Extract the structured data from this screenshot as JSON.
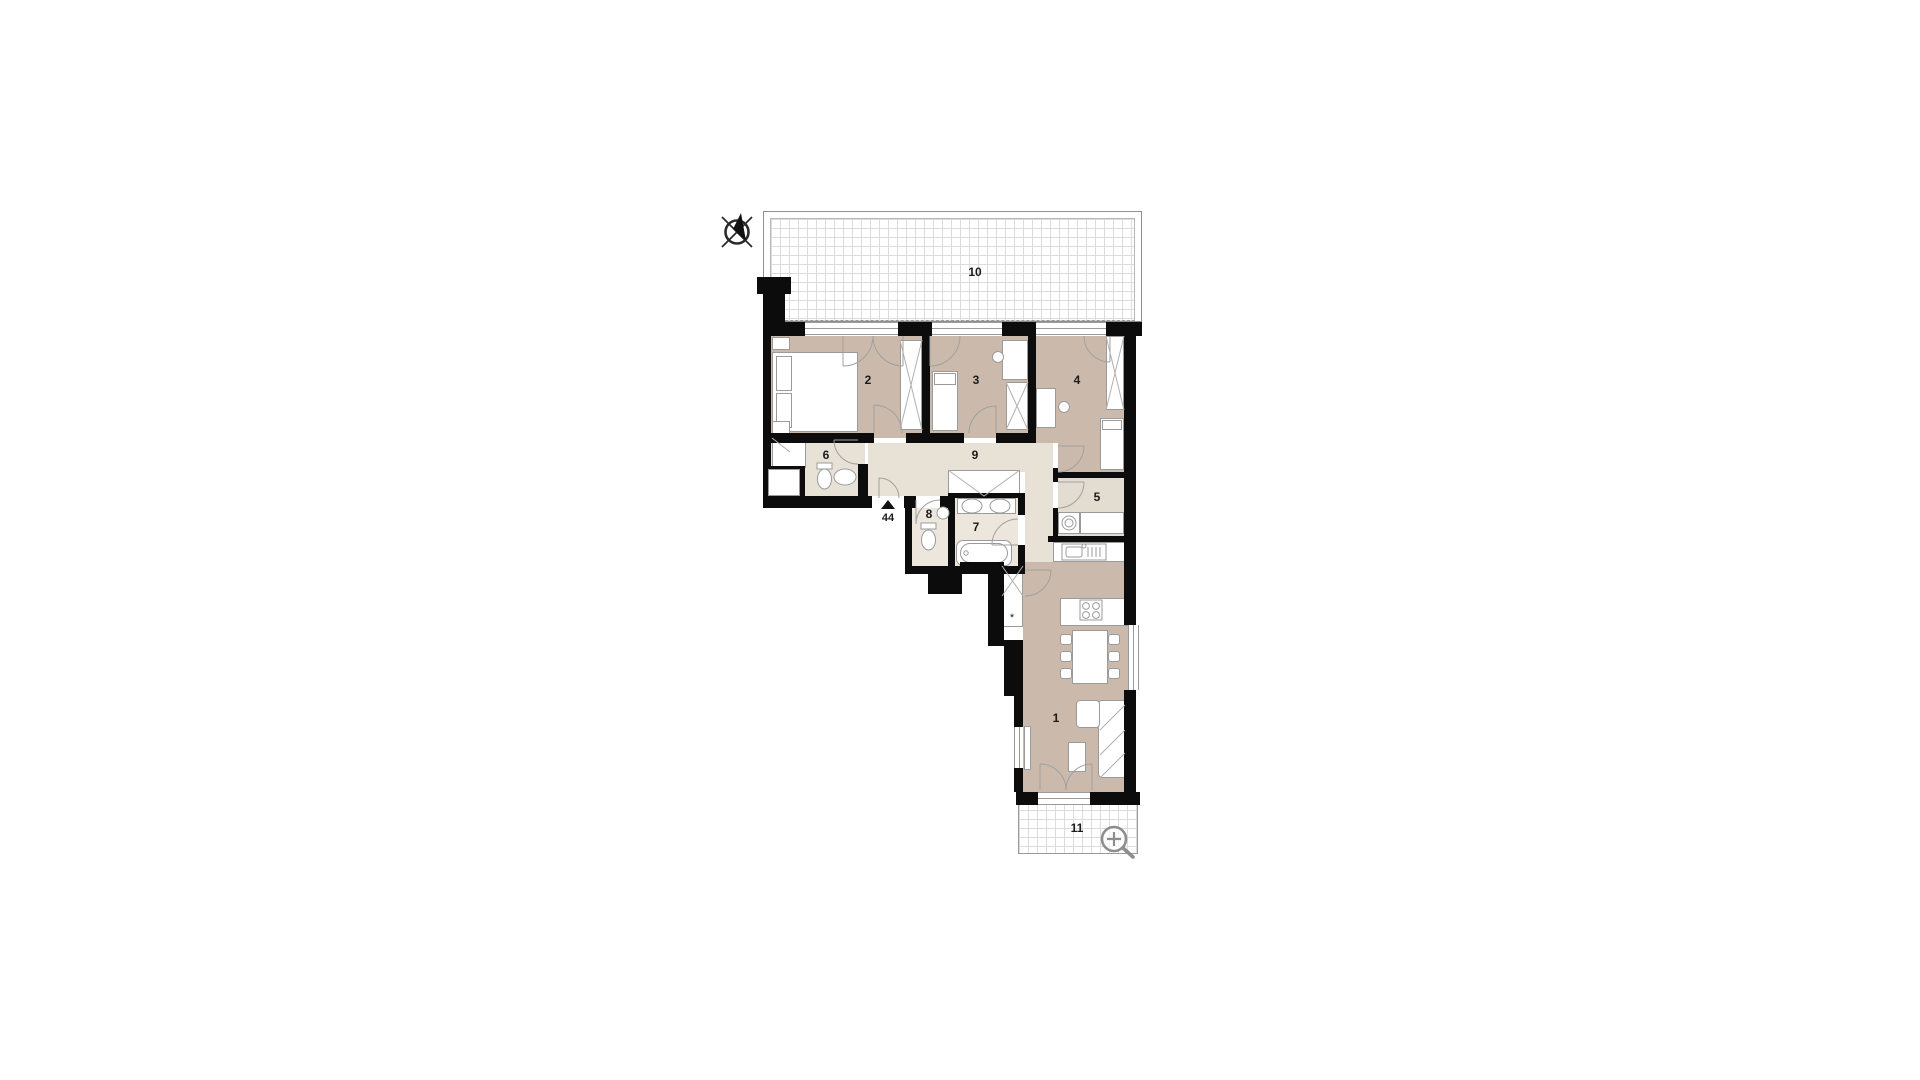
{
  "plan": {
    "title": "apartment-floor-plan",
    "rooms": {
      "r1": {
        "label": "1"
      },
      "r2": {
        "label": "2"
      },
      "r3": {
        "label": "3"
      },
      "r4": {
        "label": "4"
      },
      "r5": {
        "label": "5"
      },
      "r6": {
        "label": "6"
      },
      "r7": {
        "label": "7"
      },
      "r8": {
        "label": "8"
      },
      "r9": {
        "label": "9"
      },
      "r10": {
        "label": "10"
      },
      "r11": {
        "label": "11"
      }
    },
    "entrance": {
      "number": "44"
    },
    "closet_marker": "*",
    "icons": [
      {
        "name": "compass-icon"
      },
      {
        "name": "magnifier-zoom-icon"
      }
    ],
    "colors": {
      "wall": "#0c0c0c",
      "room_beige": "#cbbaab",
      "room_cream": "#e8e1d6",
      "room_utility": "#e3dcd1",
      "grid_line": "#dcdcdc",
      "furniture_stroke": "#9b9b9b"
    }
  }
}
